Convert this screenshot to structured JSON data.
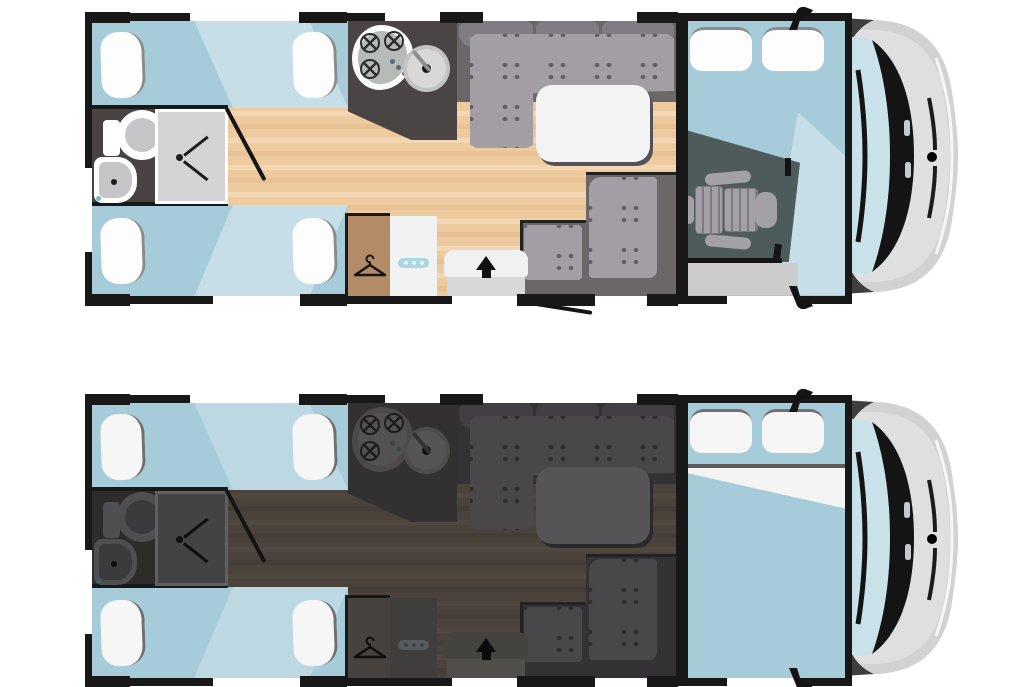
{
  "canvas": {
    "width": 1024,
    "height": 687,
    "background": "#ffffff"
  },
  "subject": "motorhome-floorplan-top-view",
  "vehicle": {
    "body": "#d2d2d2",
    "body_inner": "#dfdfdf",
    "highlight": "#f7f7f7",
    "cab_wall": "#3f3f3f",
    "windshield": "#c9e1e8",
    "trim": "#141414",
    "vent": "#c3c9cc",
    "logo_dot": "#ce2d38",
    "mirror": "#141414"
  },
  "plans": [
    {
      "id": "day",
      "cab_state": "driver-seat-visible",
      "position_top": 12,
      "theme": {
        "wall": "#181818",
        "blue": "#a7ccd9",
        "blue_light": "#c6dee8",
        "floor_a": "#eeca9f",
        "floor_b": "#f3d7b4",
        "floor_c": "#e9c195",
        "bath_bg": "#494243",
        "fixture": "#ffffff",
        "fixture_inner": "#c6c6c9",
        "shower_tray": "#d4d4d5",
        "shower_edge": "#ffffff",
        "mark": "#1c1c1c",
        "accent_dot": "#79b4c6",
        "counter": "#4a4444",
        "hob_outer": "#fbfbfb",
        "hob_inner": "#b6bbb7",
        "burner": "#2e2e2e",
        "hob_dot": "#537077",
        "sink": "#d8d8d8",
        "sink_dot": "#161616",
        "faucet": "#8e8e8e",
        "sofa_base": "#6b6768",
        "sofa_back": "#807c83",
        "cushion": "#a29ea4",
        "pattern": "#625e67",
        "table": "#f3f3f4",
        "table_shadow": "#56525a",
        "wardrobe": "#b38b66",
        "hanger": "#151515",
        "fridge": "#f2f2f2",
        "fridge_handle": "#abd7e5",
        "handle_dot": "#ffffff",
        "mat": "#f1f1f1",
        "step": "#d8d8d8",
        "arrow": "#111111",
        "cab_floor": "#4d5c5b",
        "cab_strip": "#cccccc",
        "seat": "#a3a0a7",
        "seat_line": "#7d7a83",
        "pillow": "#fdfdfd",
        "pillow_edge": "#8b8b8b",
        "bed_divider": "#5a5a5a",
        "sheet": "#f4f4f4"
      }
    },
    {
      "id": "night",
      "cab_state": "drop-down-bed-lowered",
      "position_top": 394,
      "theme": {
        "wall": "#181818",
        "blue": "#a7ccd9",
        "blue_light": "#bcd8e2",
        "floor_a": "#4a423b",
        "floor_b": "#50483f",
        "floor_c": "#453e38",
        "bath_bg": "#2e2c2b",
        "fixture": "#4f4f51",
        "fixture_inner": "#3b3b3d",
        "shower_tray": "#434345",
        "shower_edge": "#606062",
        "mark": "#0e0e0e",
        "accent_dot": "#3c606c",
        "counter": "#323030",
        "hob_outer": "#4b4a48",
        "hob_inner": "#545250",
        "burner": "#1d1d1d",
        "hob_dot": "#3c4347",
        "sink": "#565554",
        "sink_dot": "#101010",
        "faucet": "#333333",
        "sofa_base": "#343234",
        "sofa_back": "#413f43",
        "cushion": "#494749",
        "pattern": "#2d2c2f",
        "table": "#565457",
        "table_shadow": "#2a292b",
        "wardrobe": "#46423f",
        "hanger": "#0d0d0d",
        "fridge": "#403e3c",
        "fridge_handle": "#545a5e",
        "handle_dot": "#3c3f41",
        "mat": "#454340",
        "step": "#504e4a",
        "arrow": "#0b0b0b",
        "cab_floor": "#4d5c5b",
        "cab_strip": "#cccccc",
        "seat": "#a3a0a7",
        "seat_line": "#7d7a83",
        "pillow": "#f6f6f6",
        "pillow_edge": "#707070",
        "bed_divider": "#5a5a5a",
        "sheet": "#f4f4f4"
      }
    }
  ],
  "icons": [
    "hanger-icon",
    "entry-arrow-icon",
    "hob-burner-icon",
    "wing-mirror-icon",
    "toilet",
    "washbasin",
    "shower-drain",
    "driver-seat",
    "logo-dot"
  ]
}
